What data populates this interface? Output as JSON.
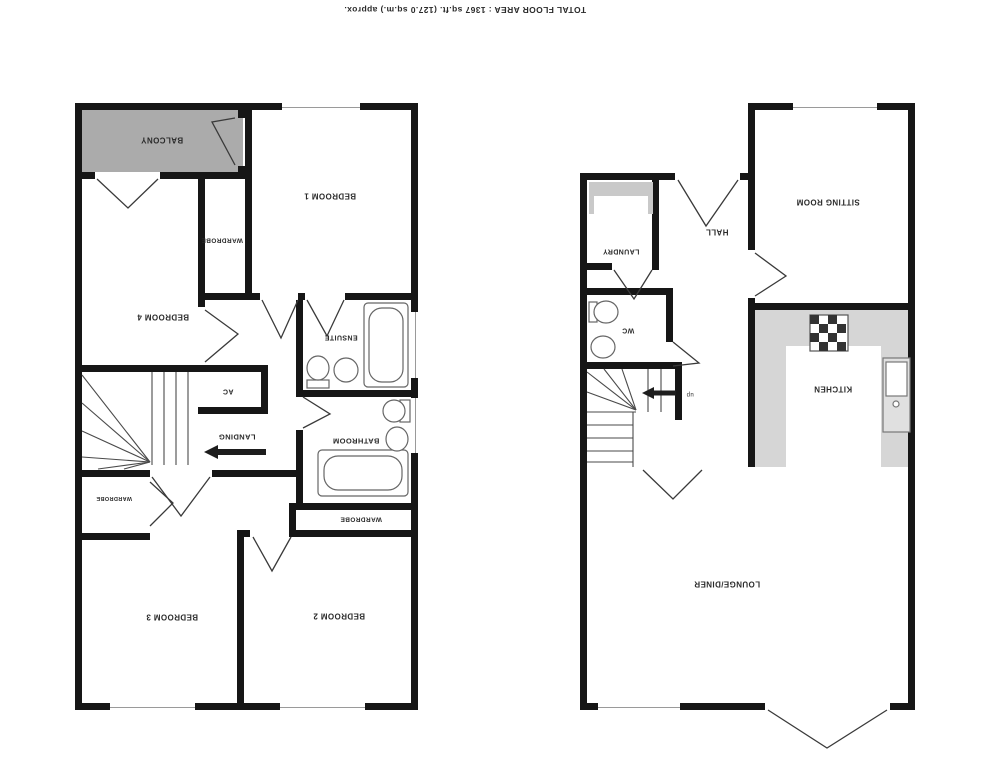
{
  "title": "TOTAL FLOOR AREA : 1367 sq.ft. (127.0 sq.m.) approx.",
  "colors": {
    "wall": "#161616",
    "balcony": "#ababab",
    "counter": "#d6d6d6",
    "label": "#2a2a2a"
  },
  "floor1": {
    "balcony": "BALCONY",
    "bedroom1": "BEDROOM 1",
    "wardrobe_top": "WARDROBE",
    "bedroom4": "BEDROOM 4",
    "ensuite": "ENSUITE",
    "ac": "AC",
    "landing": "LANDING",
    "bathroom": "BATHROOM",
    "wardrobe_mid": "WARDROBE",
    "wardrobe_bed3": "WARDROBE",
    "bedroom3": "BEDROOM 3",
    "bedroom2": "BEDROOM 2"
  },
  "floor0": {
    "laundry": "LAUNDRY",
    "hall": "HALL",
    "sitting_room": "SITTING ROOM",
    "wc": "WC",
    "kitchen": "KITCHEN",
    "lounge_diner": "LOUNGE/DINER",
    "stairs_direction": "up"
  }
}
